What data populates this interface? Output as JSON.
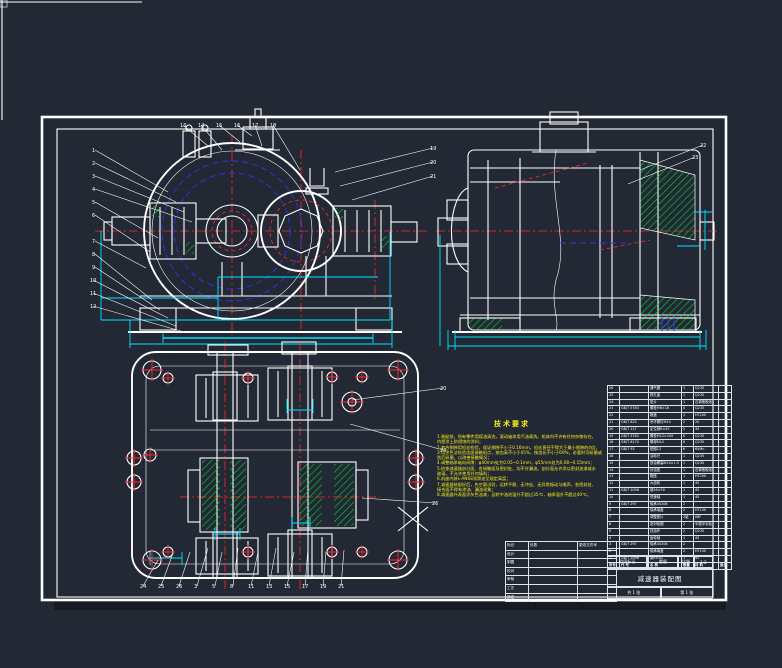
{
  "app": {
    "background_color": "#222834",
    "line_color": "#ffffff",
    "centerline_color": "#ff2a2a",
    "dimension_color": "#00e5ff",
    "hatch_color": "#00dd33",
    "hidden_line_color": "#3434e8",
    "annotation_color": "#f6ef1a"
  },
  "tech_requirements": {
    "title": "技术要求",
    "lines": [
      "1.装配前，所有零件用煤油清洗，滚动轴承用汽油清洗，机体内不许有任何杂物存在，",
      "  内壁涂上防侵蚀的涂料；",
      "2.啮合侧隙用铅丝检验，保证侧隙不小于0.16mm，铅丝直径不得大于最小侧隙的4倍；",
      "3.用涂色法检验齿面接触斑点，按齿高不小于45%，按齿长不小于60%，必要时可研磨或",
      "  刮后研磨，以改善接触情况；",
      "4.调整轴承轴向间隙：φ40mm处为0.05~0.1mm，φ55mm处为0.08~0.15mm；",
      "5.检查减速器剖分面、各接触面及密封处，均不许漏油。剖分面允许涂以密封油漆或水",
      "  玻璃，不允许使用任何填料；",
      "6.机座内装L-AN68润滑油至规定高度；",
      "7.减速器装配好后，先空载试验，运转平稳、无冲击、无异常振动与噪声，各密封处、",
      "  接合面不得有渗油、漏油现象；",
      "8.减速器外表面涂灰色油漆，运转中油池温升不超过35℃，轴承温升不超过40℃。"
    ]
  },
  "bom": {
    "headers": [
      "序号",
      "代  号",
      "名  称",
      "数量",
      "材  料",
      "备注"
    ],
    "rows": [
      [
        "26",
        "",
        "通气器",
        "1",
        "Q235",
        ""
      ],
      [
        "25",
        "",
        "视孔盖",
        "1",
        "Q235",
        ""
      ],
      [
        "24",
        "",
        "垫片",
        "1",
        "石棉橡胶纸",
        ""
      ],
      [
        "23",
        "GB/T 5783",
        "螺栓M6×16",
        "4",
        "Q235",
        ""
      ],
      [
        "22",
        "",
        "箱盖",
        "1",
        "HT200",
        ""
      ],
      [
        "21",
        "GB/T 825",
        "吊环螺钉M10",
        "2",
        "20",
        ""
      ],
      [
        "20",
        "GB/T 117",
        "定位销8×35",
        "2",
        "35",
        ""
      ],
      [
        "19",
        "GB/T 5782",
        "螺栓M12×100",
        "6",
        "Q235",
        ""
      ],
      [
        "18",
        "GB/T 6170",
        "螺母M12",
        "6",
        "Q235",
        ""
      ],
      [
        "17",
        "GB/T 93",
        "垫圈12",
        "6",
        "65Mn",
        ""
      ],
      [
        "16",
        "",
        "油标尺",
        "1",
        "Q235",
        ""
      ],
      [
        "15",
        "",
        "放油螺塞M14×1.5",
        "1",
        "Q235",
        ""
      ],
      [
        "14",
        "",
        "封油垫",
        "1",
        "石棉橡胶纸",
        ""
      ],
      [
        "13",
        "",
        "箱座",
        "1",
        "HT200",
        ""
      ],
      [
        "12",
        "",
        "大齿轮",
        "1",
        "45",
        ""
      ],
      [
        "11",
        "GB/T 1096",
        "键16×50",
        "1",
        "45",
        ""
      ],
      [
        "10",
        "",
        "低速轴",
        "1",
        "45",
        ""
      ],
      [
        "9",
        "GB/T 297",
        "轴承30208",
        "2",
        "",
        ""
      ],
      [
        "8",
        "",
        "轴承端盖",
        "2",
        "HT150",
        ""
      ],
      [
        "7",
        "",
        "调整垫片",
        "2组",
        "08F",
        ""
      ],
      [
        "6",
        "",
        "密封毡圈",
        "2",
        "半粗羊毛毡",
        ""
      ],
      [
        "5",
        "",
        "挡油环",
        "2",
        "Q235",
        ""
      ],
      [
        "4",
        "",
        "齿轮轴",
        "1",
        "45",
        ""
      ],
      [
        "3",
        "GB/T 297",
        "轴承30206",
        "2",
        "",
        ""
      ],
      [
        "2",
        "",
        "轴承端盖",
        "2",
        "HT150",
        ""
      ],
      [
        "1",
        "GB/T 1096",
        "键8×50",
        "1",
        "45",
        ""
      ]
    ]
  },
  "title_block": {
    "left_rows": [
      [
        "标记",
        "处数",
        "更改文件号"
      ],
      [
        "设计",
        "",
        ""
      ],
      [
        "制图",
        "",
        ""
      ],
      [
        "校对",
        "",
        ""
      ],
      [
        "审核",
        "",
        ""
      ],
      [
        "工艺",
        "",
        ""
      ],
      [
        "批准",
        "",
        ""
      ]
    ],
    "stage_label": "阶段标记",
    "weight_label": "重量",
    "scale_label": "比例",
    "scale_value": "1:2",
    "drawing_title": "减速器装配图",
    "sheet_total": "共 1 张",
    "sheet_no": "第 1 张"
  },
  "callouts": [
    {
      "n": "1",
      "x": 92,
      "y": 152,
      "tx": 168,
      "ty": 192
    },
    {
      "n": "2",
      "x": 92,
      "y": 165,
      "tx": 176,
      "ty": 202
    },
    {
      "n": "3",
      "x": 92,
      "y": 178,
      "tx": 184,
      "ty": 212
    },
    {
      "n": "4",
      "x": 92,
      "y": 191,
      "tx": 192,
      "ty": 222
    },
    {
      "n": "5",
      "x": 92,
      "y": 204,
      "tx": 158,
      "ty": 238
    },
    {
      "n": "6",
      "x": 92,
      "y": 217,
      "tx": 150,
      "ty": 252
    },
    {
      "n": "7",
      "x": 92,
      "y": 243,
      "tx": 146,
      "ty": 268
    },
    {
      "n": "8",
      "x": 92,
      "y": 256,
      "tx": 152,
      "ty": 300
    },
    {
      "n": "9",
      "x": 92,
      "y": 269,
      "tx": 160,
      "ty": 310
    },
    {
      "n": "10",
      "x": 90,
      "y": 282,
      "tx": 168,
      "ty": 318
    },
    {
      "n": "11",
      "x": 90,
      "y": 295,
      "tx": 176,
      "ty": 326
    },
    {
      "n": "12",
      "x": 90,
      "y": 308,
      "tx": 184,
      "ty": 332
    },
    {
      "n": "13",
      "x": 180,
      "y": 127,
      "tx": 208,
      "ty": 146
    },
    {
      "n": "14",
      "x": 198,
      "y": 127,
      "tx": 222,
      "ty": 150
    },
    {
      "n": "15",
      "x": 216,
      "y": 127,
      "tx": 240,
      "ty": 142
    },
    {
      "n": "16",
      "x": 234,
      "y": 127,
      "tx": 252,
      "ty": 136
    },
    {
      "n": "17",
      "x": 252,
      "y": 127,
      "tx": 262,
      "ty": 146
    },
    {
      "n": "18",
      "x": 270,
      "y": 127,
      "tx": 300,
      "ty": 170
    },
    {
      "n": "19",
      "x": 430,
      "y": 150,
      "tx": 335,
      "ty": 172
    },
    {
      "n": "20",
      "x": 430,
      "y": 164,
      "tx": 340,
      "ty": 186
    },
    {
      "n": "21",
      "x": 430,
      "y": 178,
      "tx": 352,
      "ty": 200
    },
    {
      "n": "22",
      "x": 700,
      "y": 147,
      "tx": 640,
      "ty": 170
    },
    {
      "n": "23",
      "x": 692,
      "y": 159,
      "tx": 628,
      "ty": 184
    },
    {
      "n": "24",
      "x": 140,
      "y": 588,
      "tx": 158,
      "ty": 560
    },
    {
      "n": "25",
      "x": 158,
      "y": 588,
      "tx": 172,
      "ty": 556
    },
    {
      "n": "26",
      "x": 176,
      "y": 588,
      "tx": 190,
      "ty": 552
    },
    {
      "n": "3",
      "x": 194,
      "y": 588,
      "tx": 208,
      "ty": 548
    },
    {
      "n": "5",
      "x": 212,
      "y": 588,
      "tx": 222,
      "ty": 552
    },
    {
      "n": "8",
      "x": 230,
      "y": 588,
      "tx": 238,
      "ty": 548
    },
    {
      "n": "11",
      "x": 248,
      "y": 588,
      "tx": 258,
      "ty": 552
    },
    {
      "n": "13",
      "x": 266,
      "y": 588,
      "tx": 276,
      "ty": 548
    },
    {
      "n": "15",
      "x": 284,
      "y": 588,
      "tx": 294,
      "ty": 552
    },
    {
      "n": "17",
      "x": 302,
      "y": 588,
      "tx": 308,
      "ty": 548
    },
    {
      "n": "19",
      "x": 320,
      "y": 588,
      "tx": 326,
      "ty": 552
    },
    {
      "n": "21",
      "x": 338,
      "y": 588,
      "tx": 344,
      "ty": 550
    },
    {
      "n": "20",
      "x": 440,
      "y": 390,
      "tx": 352,
      "ty": 400
    },
    {
      "n": "24",
      "x": 440,
      "y": 452,
      "tx": 350,
      "ty": 424
    },
    {
      "n": "26",
      "x": 432,
      "y": 505,
      "tx": 362,
      "ty": 498
    }
  ]
}
